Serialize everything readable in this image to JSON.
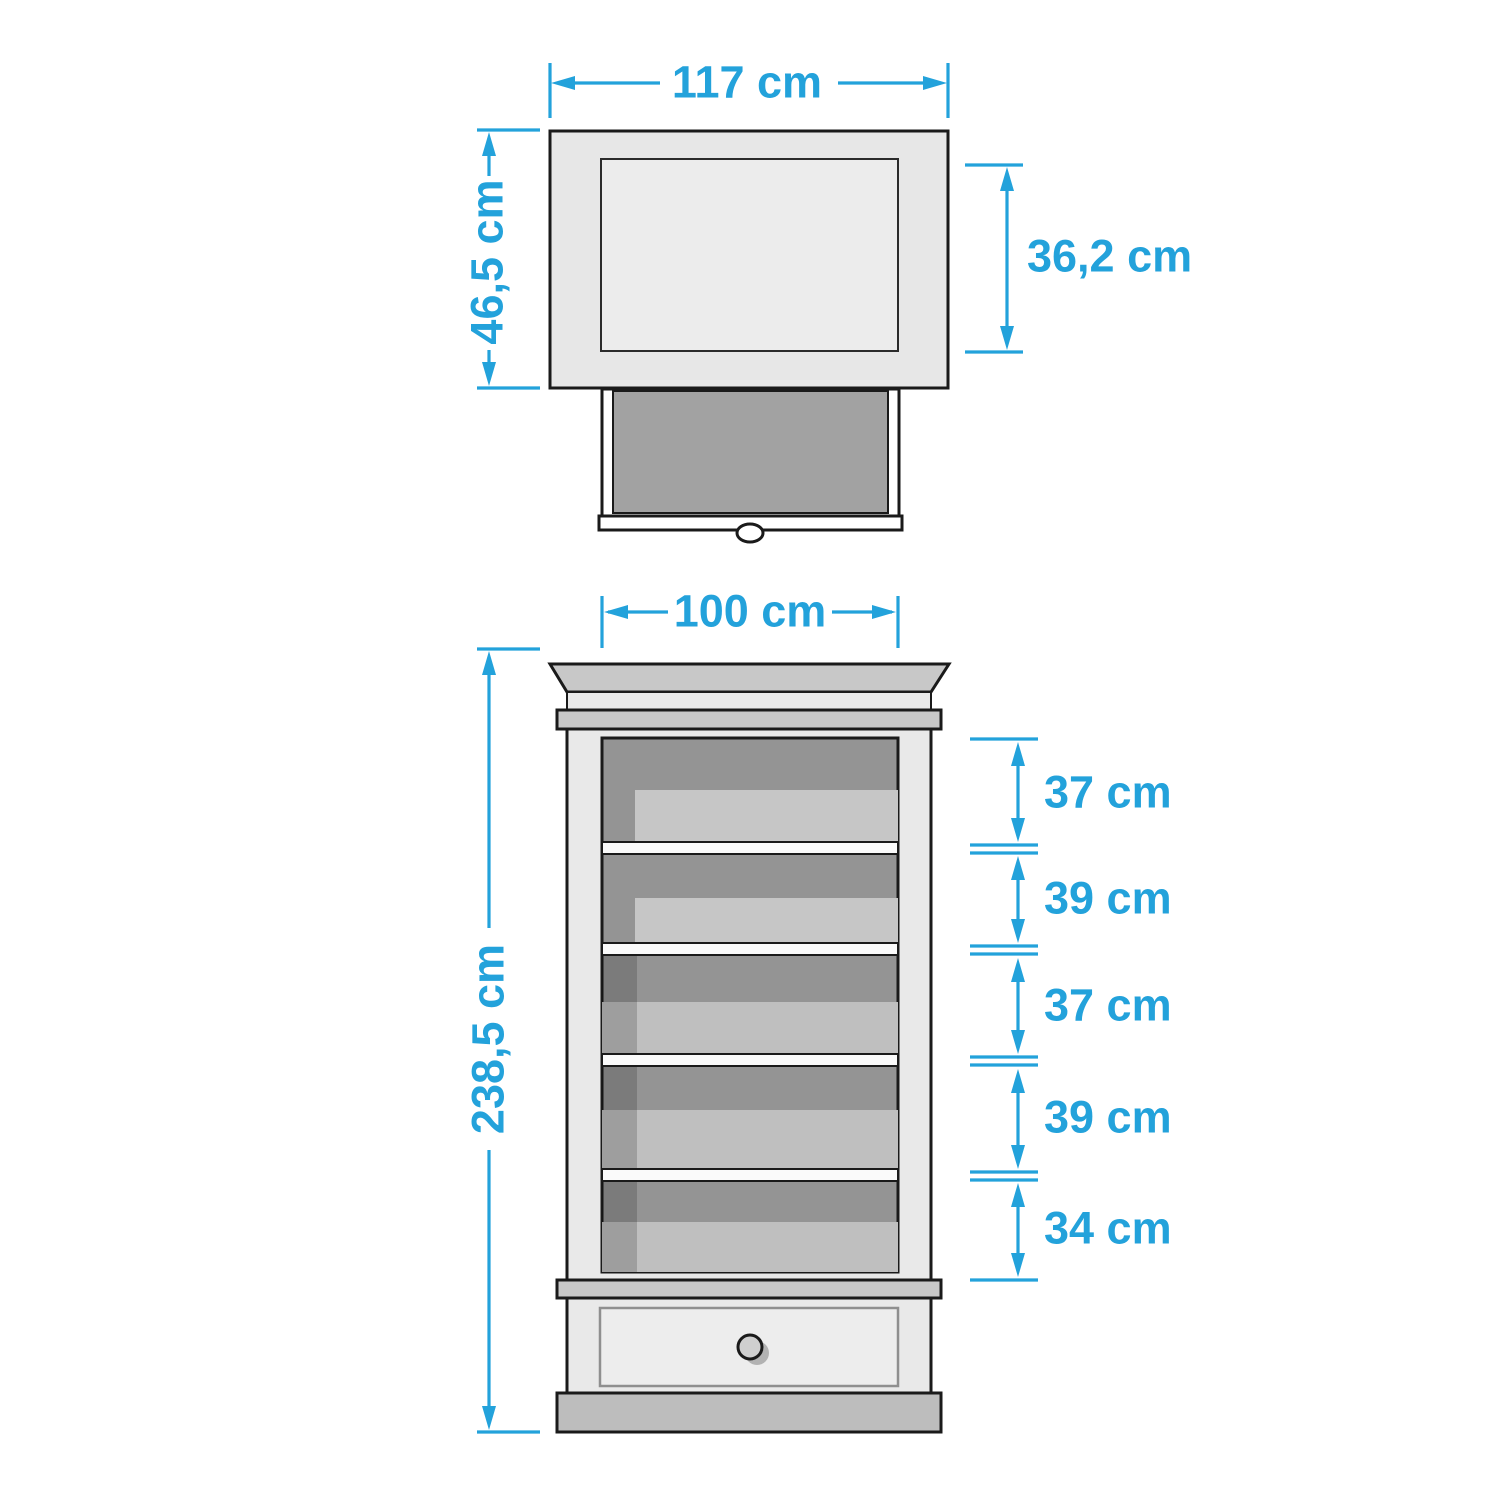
{
  "diagram": {
    "title": "cabinet-dimension-drawing",
    "unit": "cm",
    "accent_color": "#23a2db",
    "top_view": {
      "width_label": "117 cm",
      "depth_label": "46,5 cm",
      "inner_depth_label": "36,2 cm"
    },
    "front_view": {
      "width_label": "100 cm",
      "height_label": "238,5 cm",
      "compartment_labels": [
        "37 cm",
        "39 cm",
        "37 cm",
        "39 cm",
        "34 cm"
      ]
    }
  }
}
